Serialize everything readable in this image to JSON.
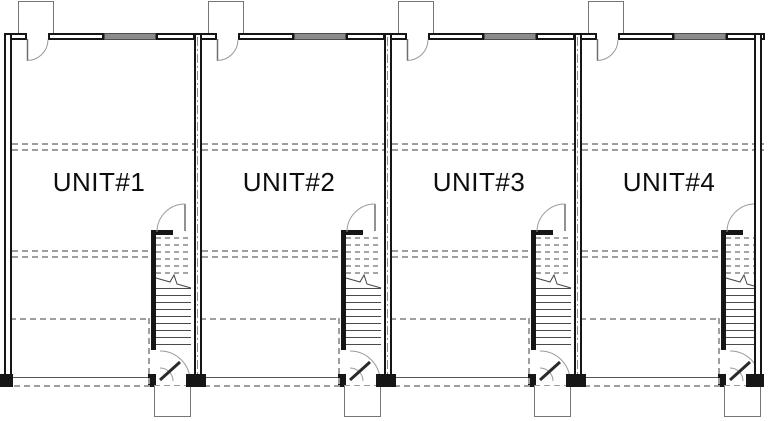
{
  "plan": {
    "type": "floor-plan",
    "units": [
      {
        "label": "UNIT#1"
      },
      {
        "label": "UNIT#2"
      },
      {
        "label": "UNIT#3"
      },
      {
        "label": "UNIT#4"
      }
    ],
    "colors": {
      "wall": "#161616",
      "thin_line": "#555555",
      "dashed_line": "#9e9e9e",
      "door_swing": "#9a9a9a",
      "window_fill": "#8c8c8c",
      "background": "#ffffff",
      "label_text": "#0d0d0d"
    }
  }
}
